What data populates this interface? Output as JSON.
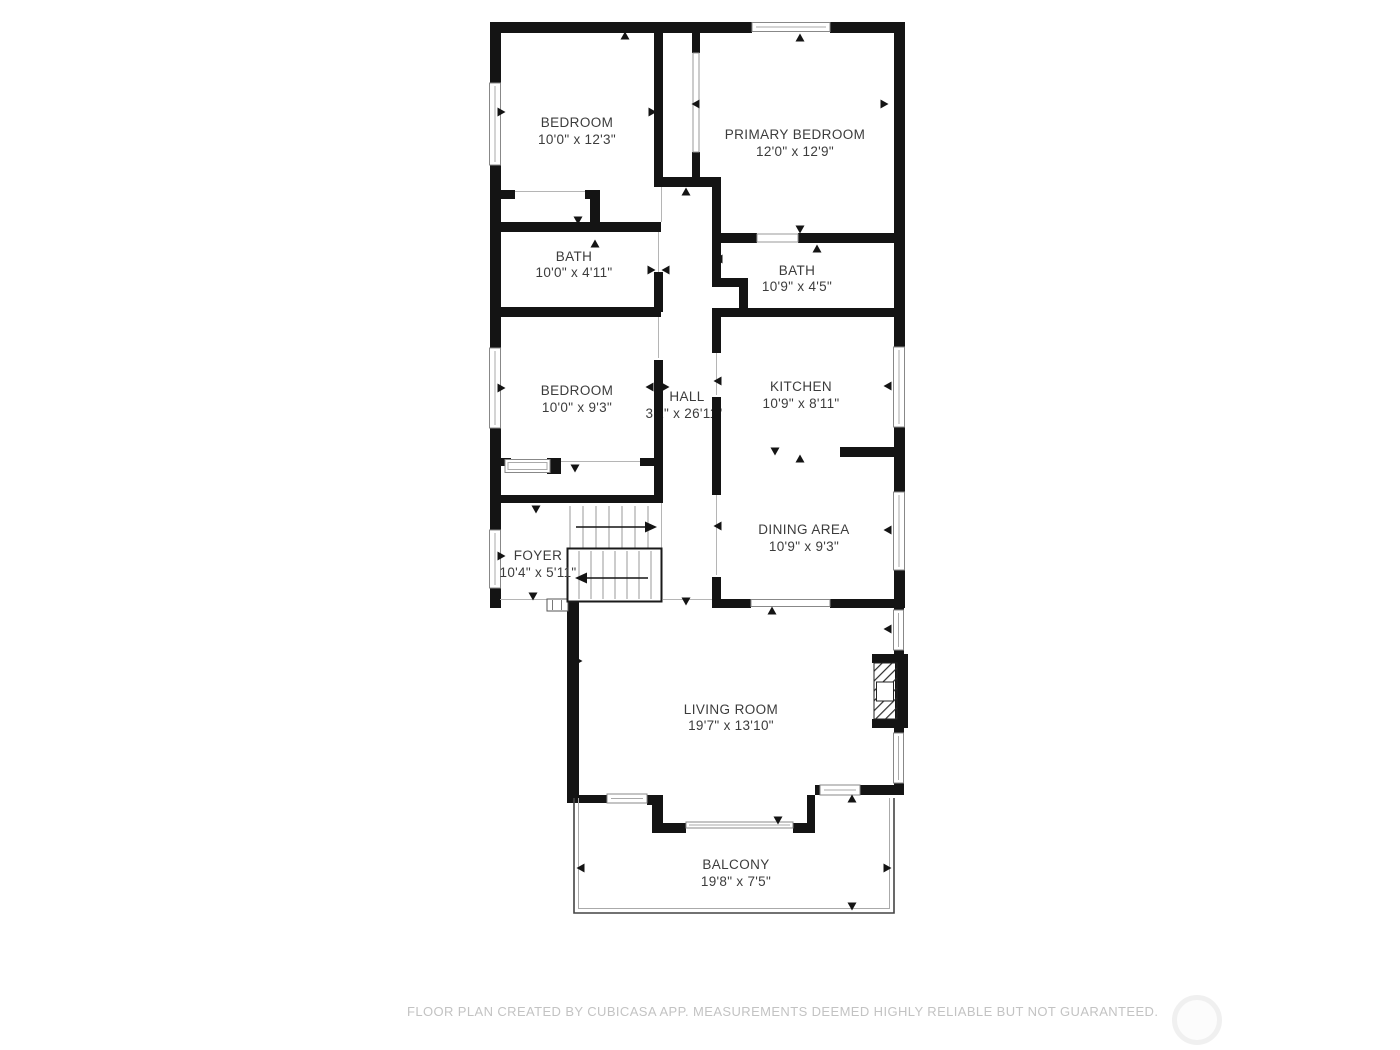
{
  "floorplan": {
    "wall_color": "#141414",
    "label_color": "#3c3c3c",
    "rooms": [
      {
        "id": "bedroom-top",
        "name": "BEDROOM",
        "dims": "10'0\" x 12'3\""
      },
      {
        "id": "primary-bedroom",
        "name": "PRIMARY BEDROOM",
        "dims": "12'0\" x 12'9\""
      },
      {
        "id": "bath-left",
        "name": "BATH",
        "dims": "10'0\" x 4'11\""
      },
      {
        "id": "bath-right",
        "name": "BATH",
        "dims": "10'9\" x 4'5\""
      },
      {
        "id": "bedroom-lower",
        "name": "BEDROOM",
        "dims": "10'0\" x 9'3\""
      },
      {
        "id": "hall",
        "name": "HALL",
        "dims": "3'2\" x 26'11\""
      },
      {
        "id": "kitchen",
        "name": "KITCHEN",
        "dims": "10'9\" x 8'11\""
      },
      {
        "id": "dining-area",
        "name": "DINING AREA",
        "dims": "10'9\" x 9'3\""
      },
      {
        "id": "foyer",
        "name": "FOYER",
        "dims": "10'4\" x 5'11\""
      },
      {
        "id": "living-room",
        "name": "LIVING ROOM",
        "dims": "19'7\" x 13'10\""
      },
      {
        "id": "balcony",
        "name": "BALCONY",
        "dims": "19'8\" x 7'5\""
      }
    ]
  },
  "footer": {
    "disclaimer": "FLOOR PLAN CREATED BY CUBICASA APP. MEASUREMENTS DEEMED HIGHLY RELIABLE BUT NOT GUARANTEED.",
    "disclaimer_color": "#c3c3c3"
  }
}
